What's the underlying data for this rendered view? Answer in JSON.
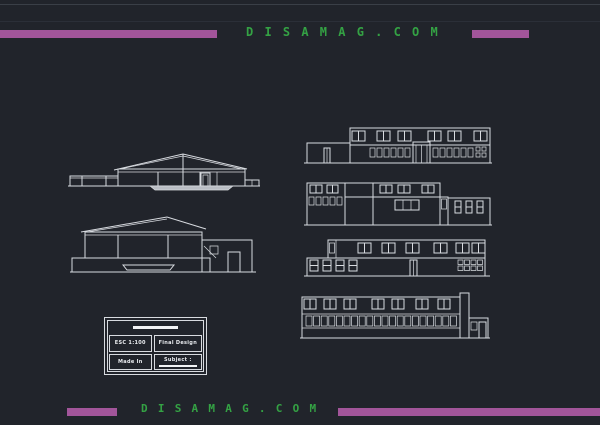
{
  "watermark": {
    "top": "D I S A M A G . C O M",
    "bottom": "D I S A M A G . C O M"
  },
  "title_block": {
    "scale": "ESC 1:100",
    "stage": "Final Design",
    "author": "Made In",
    "subject": "Subject :"
  },
  "colors": {
    "background": "#21242b",
    "accent_purple": "#a2559a",
    "brand_green": "#34a244",
    "drawing_line": "#d8dbe0"
  },
  "drawings": {
    "left_top": "building cross-section with pitched roof",
    "left_bottom": "side elevation with pitched roof and annex",
    "right_1": "front elevation: upper window pairs, lower window strip, central entrance",
    "right_2": "rear elevation with stepped massing and window groups",
    "right_3": "side elevation: upper window pairs, lower windows and door",
    "right_4": "elevation with continuous small-window band and end annex"
  }
}
